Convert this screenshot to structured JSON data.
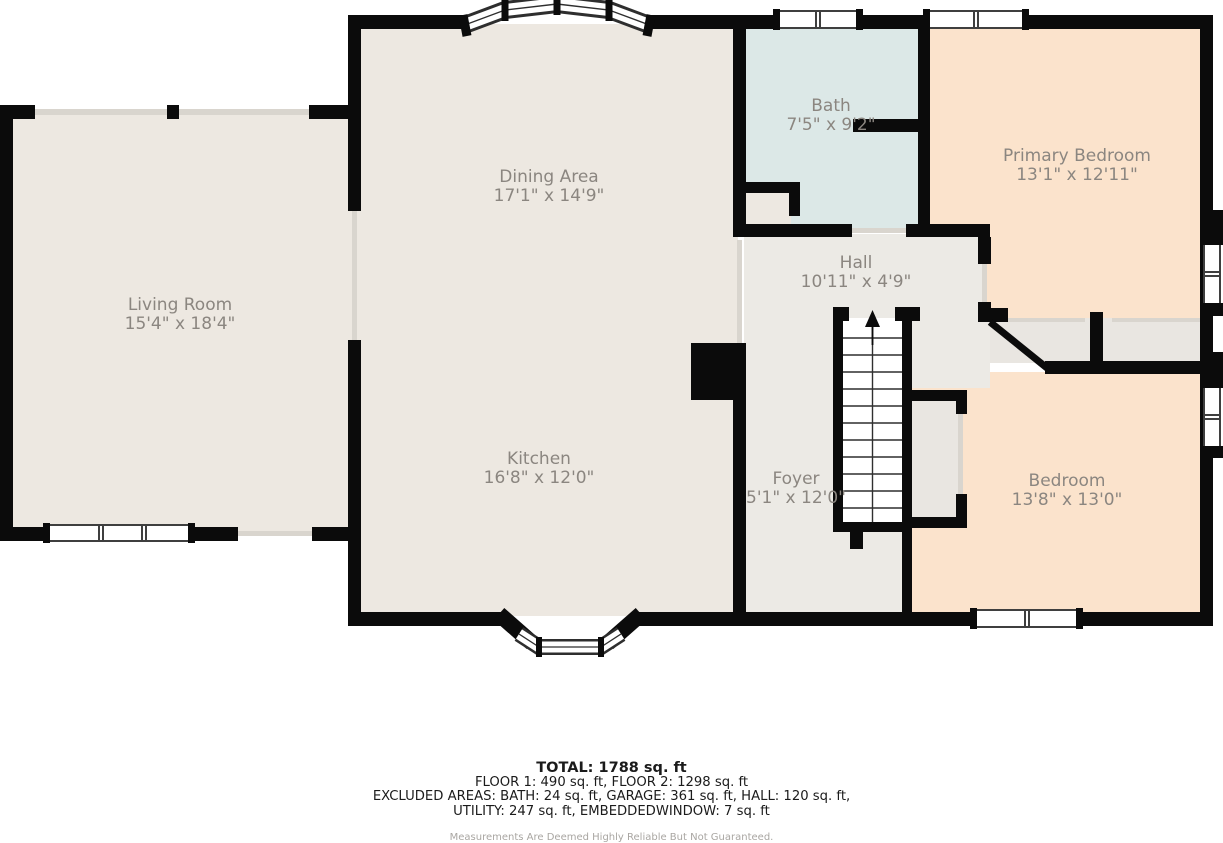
{
  "plan_title": "First floor plan",
  "colors": {
    "wall": "#0b0b0b",
    "floor_main": "#EDE8E1",
    "floor_bath": "#DCE8E7",
    "floor_bedroom": "#FBE3CC",
    "floor_hall_foyer": "#ECEAE5",
    "floor_closet": "#E9E6E1",
    "label_text": "#8B8680",
    "opening_line": "#d9d5ce"
  },
  "rooms": [
    {
      "id": "living-room",
      "name": "Living Room",
      "dims": "15'4\" x 18'4\""
    },
    {
      "id": "dining-area",
      "name": "Dining Area",
      "dims": "17'1\" x 14'9\""
    },
    {
      "id": "bath",
      "name": "Bath",
      "dims": "7'5\" x 9'2\""
    },
    {
      "id": "primary-bedroom",
      "name": "Primary Bedroom",
      "dims": "13'1\" x 12'11\""
    },
    {
      "id": "hall",
      "name": "Hall",
      "dims": "10'11\" x 4'9\""
    },
    {
      "id": "kitchen",
      "name": "Kitchen",
      "dims": "16'8\" x 12'0\""
    },
    {
      "id": "foyer",
      "name": "Foyer",
      "dims": "5'1\" x 12'0\""
    },
    {
      "id": "bedroom",
      "name": "Bedroom",
      "dims": "13'8\" x 13'0\""
    }
  ],
  "stairs": {
    "direction": "up-arrow"
  },
  "footer": {
    "total": "TOTAL: 1788 sq. ft",
    "floors": "FLOOR 1: 490 sq. ft, FLOOR 2: 1298 sq. ft",
    "excluded_line1": "EXCLUDED AREAS: BATH: 24 sq. ft, GARAGE: 361 sq. ft, HALL: 120 sq. ft,",
    "excluded_line2": "UTILITY: 247 sq. ft, EMBEDDEDWINDOW: 7 sq. ft",
    "disclaimer": "Measurements Are Deemed Highly Reliable But Not Guaranteed."
  }
}
